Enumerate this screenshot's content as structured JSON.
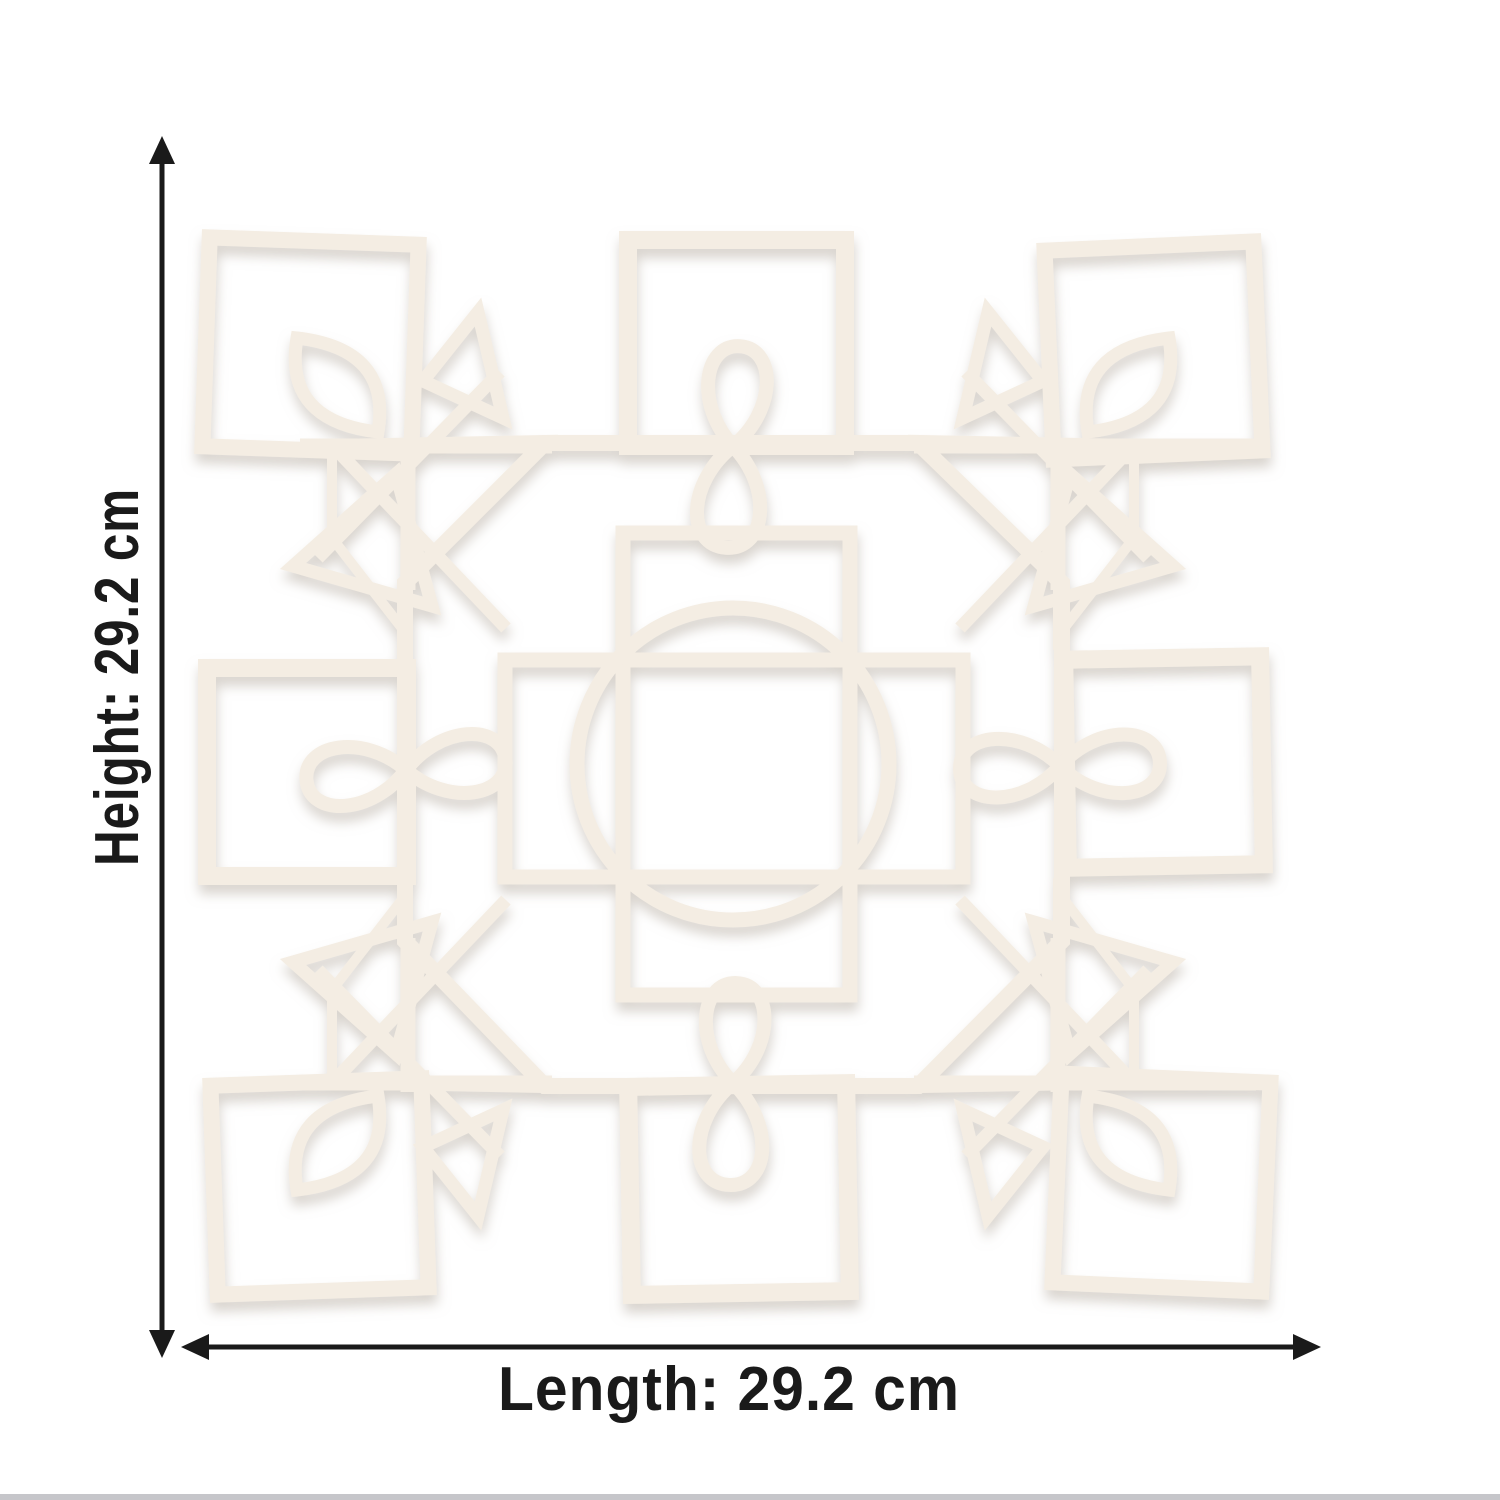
{
  "image": {
    "width": 1500,
    "height": 1500,
    "subject": "kolam rangoli pattern wooden cutout board photographed on white background"
  },
  "dimension_annotations": {
    "height": {
      "label": "Height: 29.2 cm",
      "value": "29.2",
      "unit": "cm"
    },
    "length": {
      "label": "Length: 29.2 cm",
      "value": "29.2",
      "unit": "cm"
    }
  },
  "colors": {
    "background": "#ffffff",
    "board_tan": "#dca67f",
    "board_tan_light": "#e2ac85",
    "line_white": "#f4ede3",
    "annotation": "#1a1a1a",
    "bottom_strip": "#c6c6ca",
    "shadow": "#b9b1a6"
  }
}
